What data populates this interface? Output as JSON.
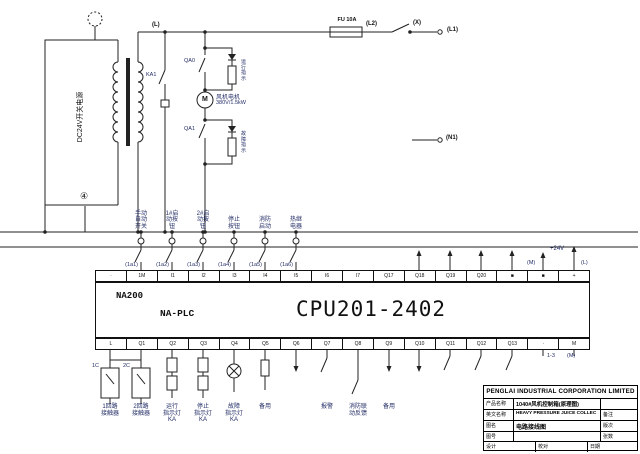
{
  "power": {
    "label": "DC24V开关电源"
  },
  "rail": {
    "l": "(L)",
    "fuse": "FU 10A",
    "l2": "(L2)",
    "x": "(X)",
    "l1": "(L1)",
    "n1": "(N1)",
    "node4": "④"
  },
  "motor": {
    "symbol": "M",
    "name": "风机电机",
    "rating": "380V/1.5kW",
    "contact_a": "KA1",
    "contact_top": "QA0",
    "contact_bottom": "QA1",
    "lamp_run": "运行指示",
    "lamp_fault": "故障指示"
  },
  "inputs": {
    "labels": [
      "手动\n自动\n开关",
      "1#启\n动按\n钮",
      "2#启\n动按\n钮",
      "停止\n按钮",
      "消防\n启动",
      "热继\n电器"
    ],
    "wires": [
      "(1a1)",
      "(1a2)",
      "(1a3)",
      "(1a4)",
      "(1a5)",
      "(1a6)"
    ]
  },
  "plc": {
    "brand": "NA200",
    "series": "NA-PLC",
    "model": "CPU201-2402",
    "plus24": "+24V",
    "wire_m": "(M)",
    "wire_l": "(L)",
    "wire_13": "1-3",
    "wire_m2": "(M)",
    "top_terminals": [
      "·",
      "1M",
      "I1",
      "I2",
      "I3",
      "I4",
      "I5",
      "I6",
      "I7",
      "Q17",
      "Q18",
      "Q19",
      "Q20",
      "■",
      "■",
      "+"
    ],
    "bottom_terminals": [
      "L",
      "Q1",
      "Q2",
      "Q3",
      "Q4",
      "Q5",
      "Q6",
      "Q7",
      "Q8",
      "Q9",
      "Q10",
      "Q11",
      "Q12",
      "Q13",
      "·",
      "M"
    ]
  },
  "outputs": {
    "coil_a": "1C",
    "coil_b": "2C",
    "labels": [
      "1回路\n接触器",
      "2回路\n接触器",
      "运行\n指示灯\nKA",
      "停止\n指示灯\nKA",
      "故障\n指示灯\nKA",
      "备用",
      "报警",
      "消防联\n动反馈",
      "备用"
    ]
  },
  "title_block": {
    "company": "PENGLAI INDUSTRIAL CORPORATION LIMITED",
    "product_label": "产品名称",
    "product_value": "1040#风机控制箱(原理图)",
    "english_label": "英文名称",
    "english_value": "HEAVY PRESSURE JUICE COLLEC",
    "note": "备注",
    "drawing_label": "图名",
    "drawing_value": "电路接线图",
    "revision_label": "版次",
    "number_label": "图号",
    "sheets_label": "张数",
    "designer_label": "设计",
    "checker_label": "校对",
    "date_label": "日期"
  }
}
